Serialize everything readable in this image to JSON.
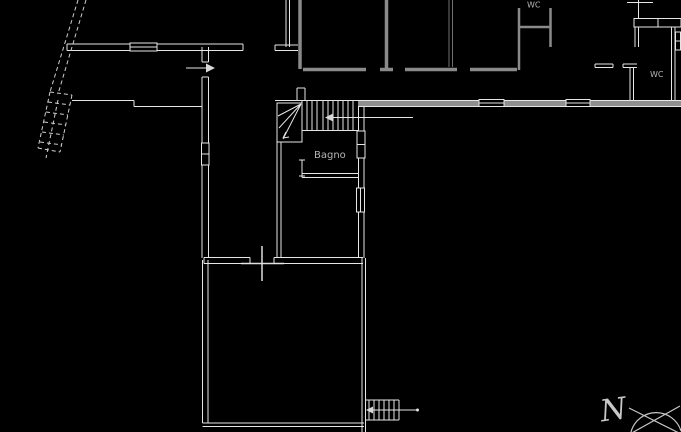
{
  "drawing": {
    "type": "architectural-floor-plan",
    "background_color": "#000000",
    "line_color": "#e6e6e6",
    "wall_gray_color": "#8f8f8f",
    "text_color": "#b5b5b5",
    "labels": {
      "wc_top": "WC",
      "wc_right": "WC",
      "bagno": "Bagno",
      "north_letter": "N"
    },
    "icons": [
      "north-compass-icon",
      "entry-arrow-right-icon",
      "stair-direction-arrow-left-icon",
      "exterior-stair-arrow-icon",
      "cross-marker-icon"
    ]
  }
}
